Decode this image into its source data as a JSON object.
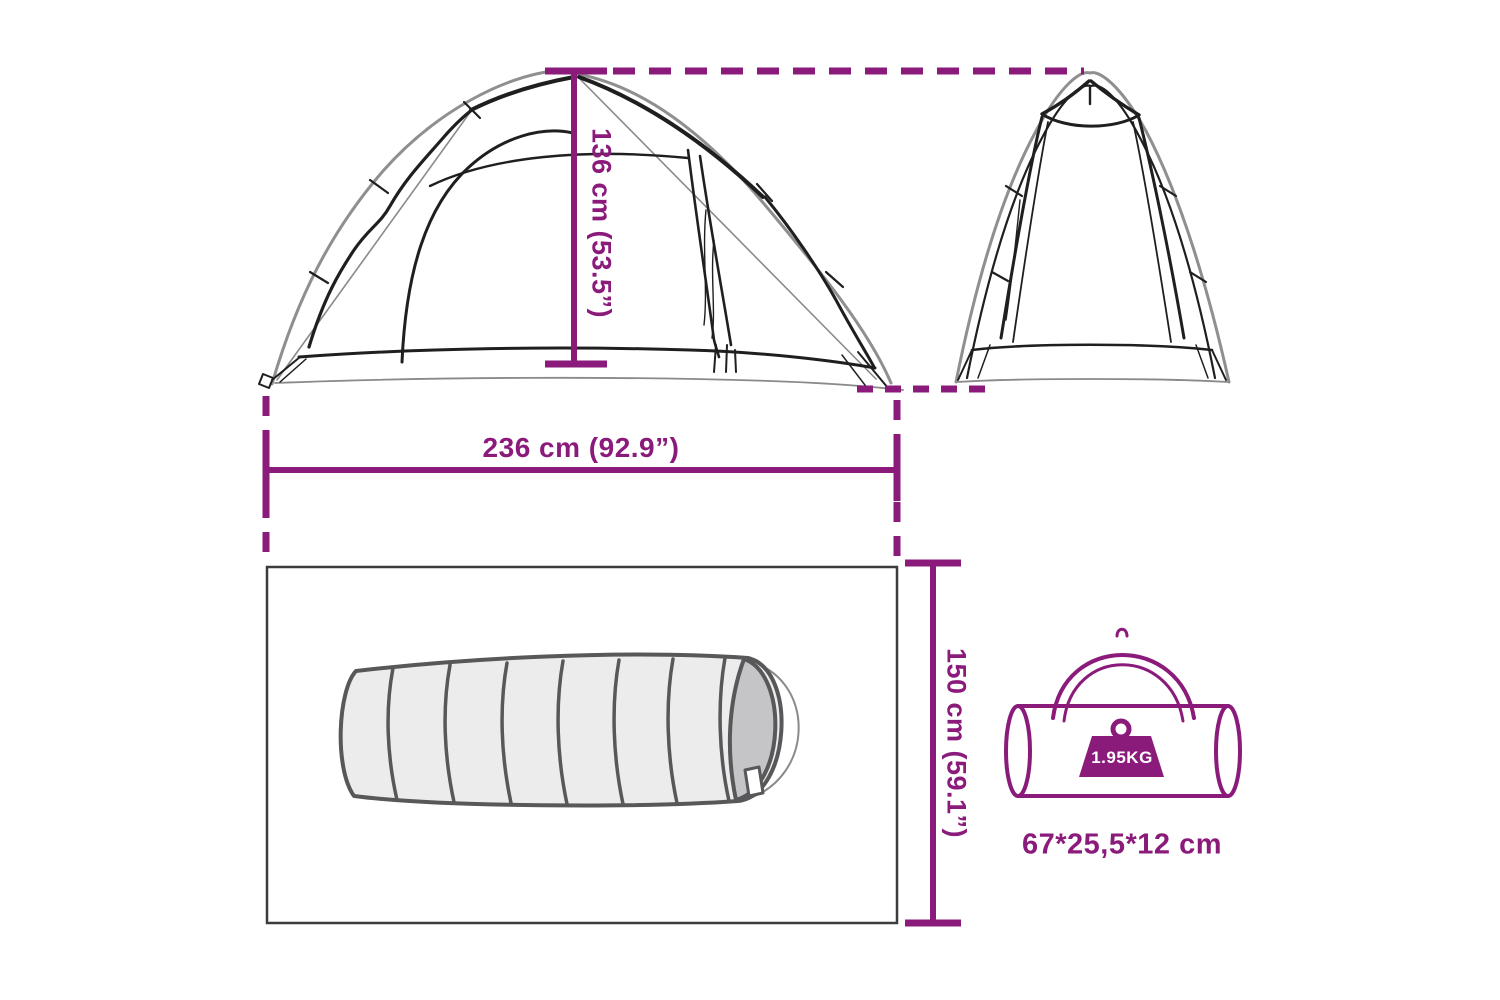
{
  "diagram_title": "Tent dimensions diagram",
  "colors": {
    "accent": "#8b1b7b",
    "ink": "#1f1f1f",
    "gray": "#8f8f8f",
    "sleeping_bag_outline": "#58585a",
    "sleeping_bag_fill": "#ececec",
    "sleeping_bag_end_fill": "#c5c5c7",
    "floor_outline": "#3c3c3e",
    "background": "#ffffff"
  },
  "dimensions": {
    "height_label": "136 cm (53.5”)",
    "width_label": "236 cm (92.9”)",
    "depth_label": "150 cm (59.1”)"
  },
  "carry_bag": {
    "weight_label": "1.95KG",
    "size_label": "67*25,5*12 cm"
  },
  "icons": {
    "weight_icon": "kettlebell-weight",
    "front_view": "tent-front-line-art",
    "side_view": "tent-side-line-art",
    "sleeping_bag": "sleeping-bag-line-art",
    "carry_bag": "duffel-carry-bag-line-art"
  }
}
